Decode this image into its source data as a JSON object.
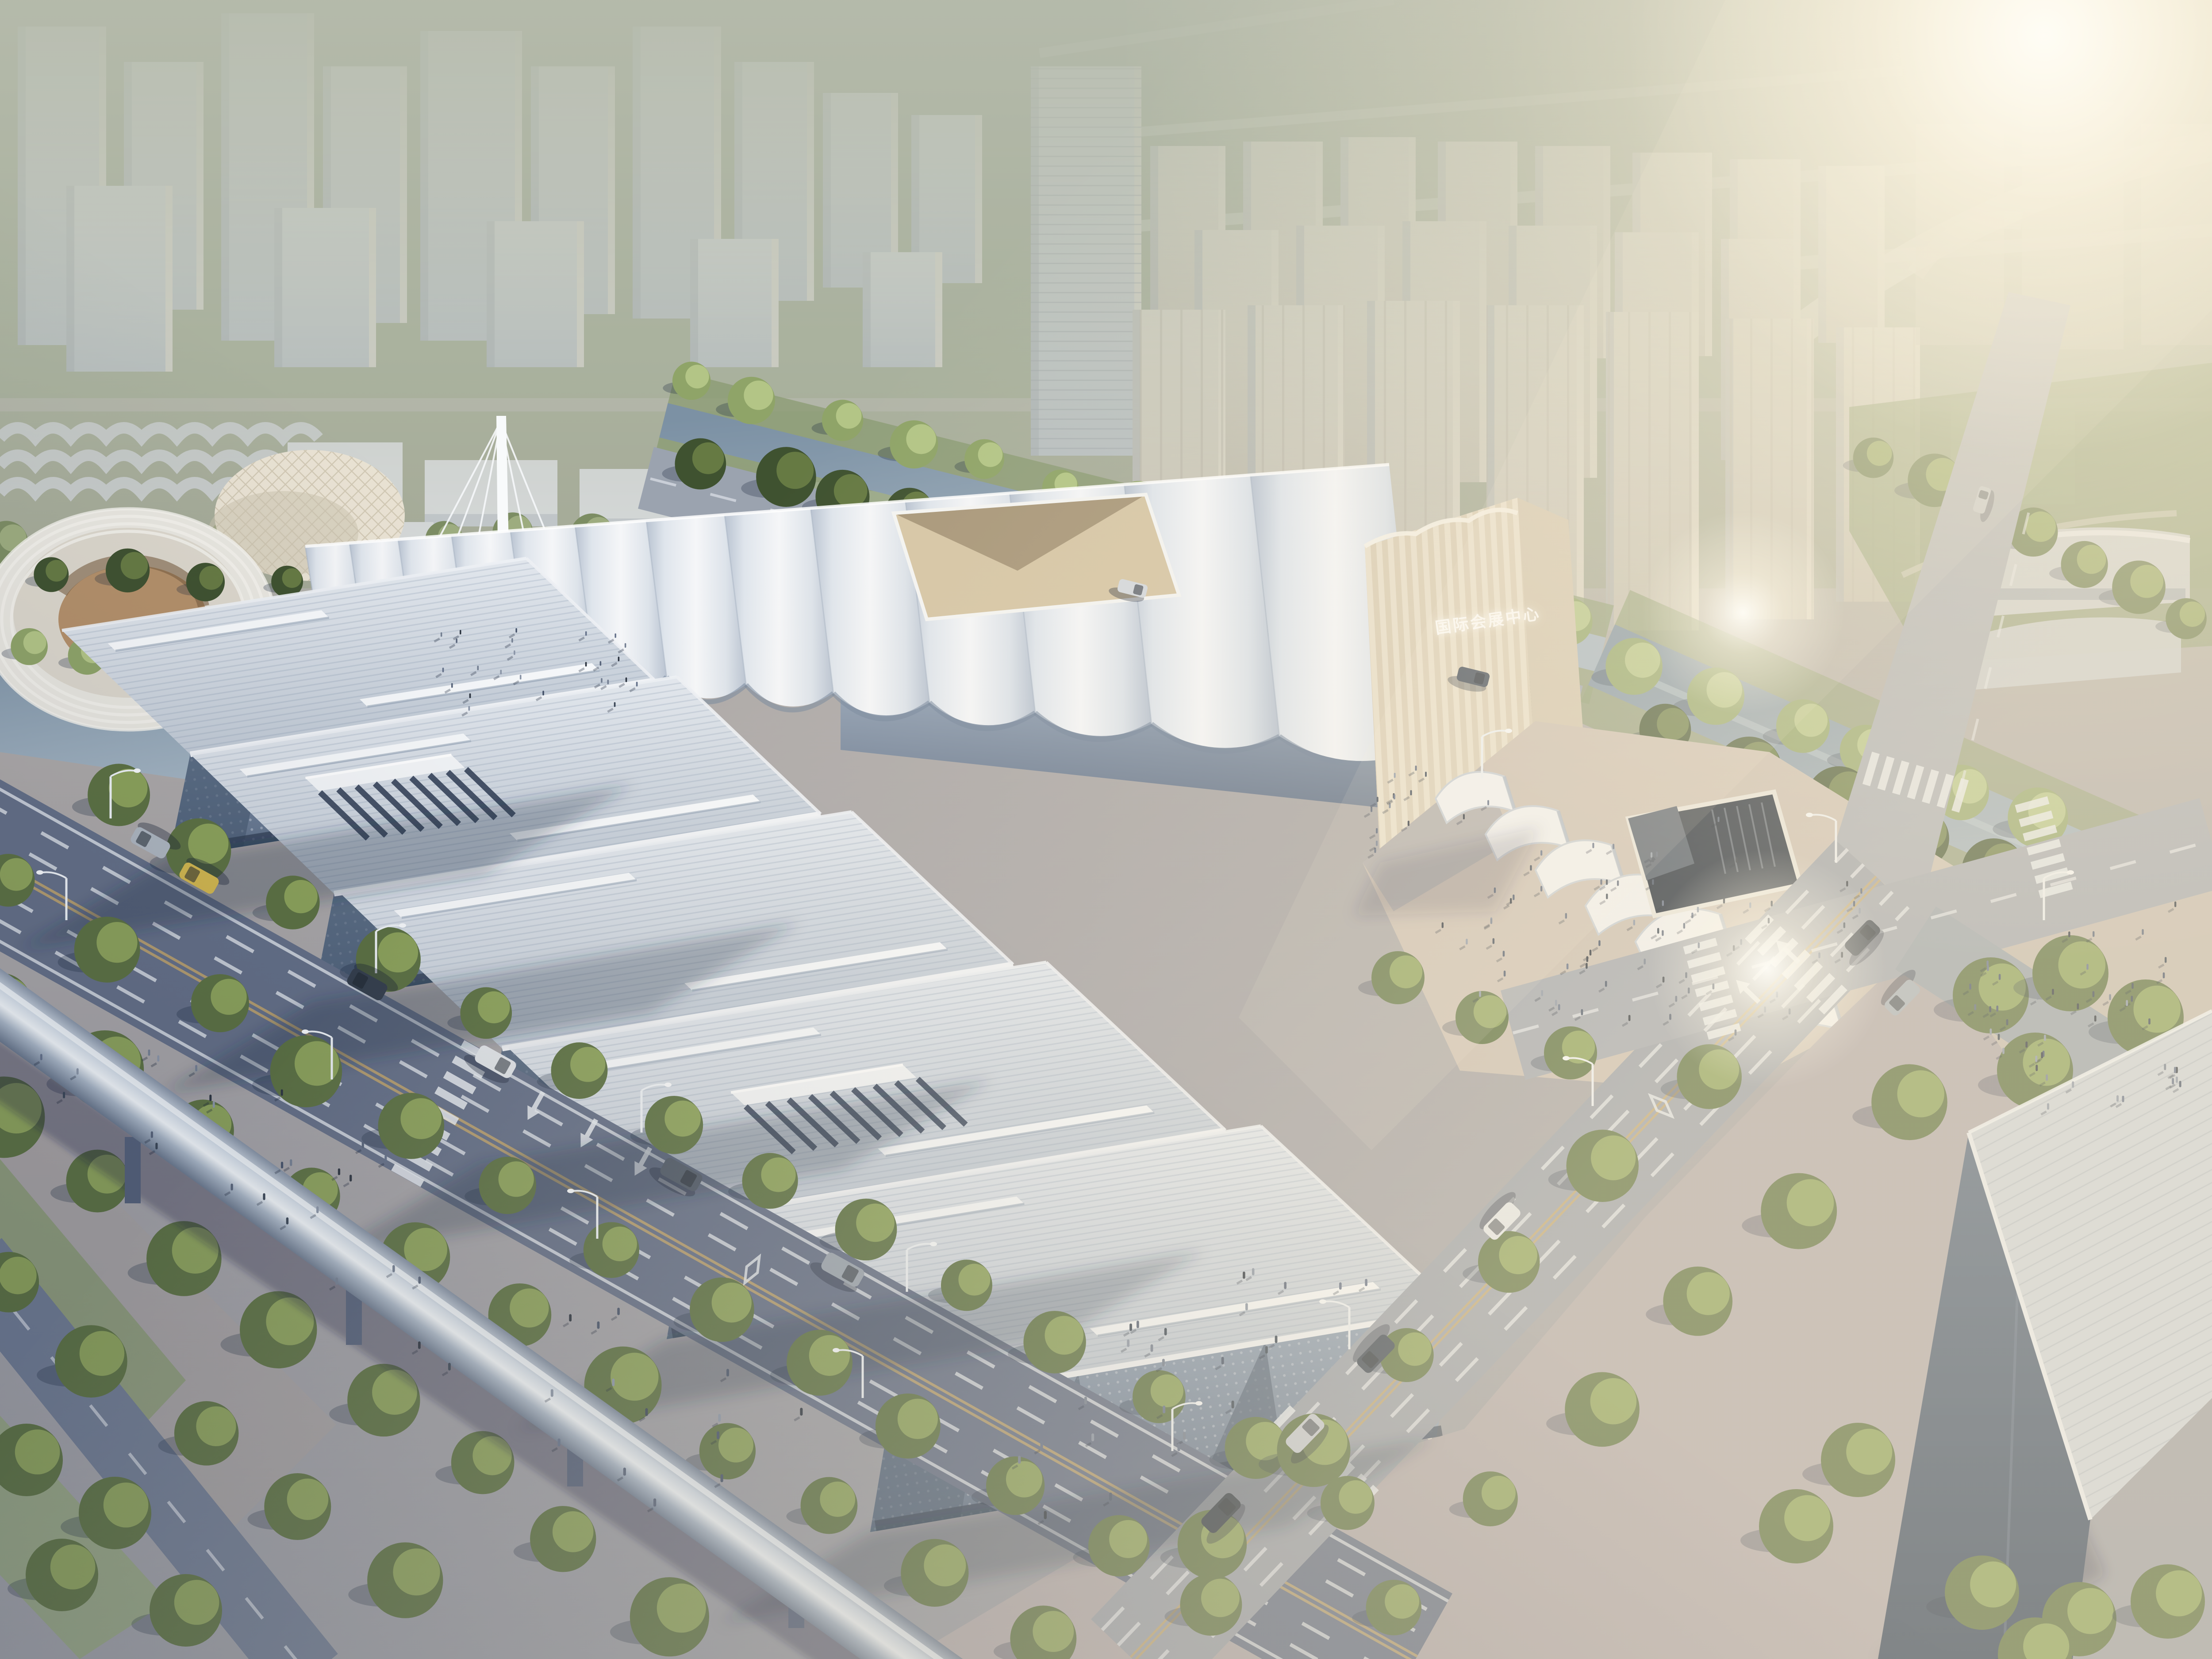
{
  "scene": {
    "type": "architectural-aerial-rendering",
    "subject": "exhibition-and-convention-center-complex",
    "building_sign": {
      "text": "国际会展中心"
    }
  },
  "palette": {
    "sky_top": "#a4ab9b",
    "sky_mid": "#b6baab",
    "sky_low": "#d8d8cb",
    "sun_core": "#fdf8ea",
    "warm_wash": "#f3e7c9",
    "field": "#95a285",
    "grass": "#8a9b72",
    "grass_bright": "#9fb083",
    "city_light": "#d4d8db",
    "city_shade": "#b6bec7",
    "city_warm": "#d8d3c6",
    "tree_dark": "#3f5230",
    "tree_mid": "#5c7142",
    "tree_light": "#94aa5e",
    "willow": "#8fa468",
    "willow_light": "#bacb8c",
    "tree_haze": "#7c8d63",
    "water": "#7b90a3",
    "water_light": "#a9bac7",
    "tent_white": "#f3f5f6",
    "tent_shade": "#c6cedb",
    "sign_wall": "#e9e0cd",
    "sign_wall_shade": "#d2c6ae",
    "sign_text_color": "#ffffff",
    "roof_light": "#e8ecf1",
    "roof_shade": "#c4cdd8",
    "fascia": "#f4f6f9",
    "facade": "#8496ad",
    "facade_dark": "#51627b",
    "facade_deep": "#3c4c62",
    "endwall": "#dcd8cf",
    "road_shade": "#646f87",
    "road_mid": "#7e8799",
    "road_light": "#9aa0ab",
    "road_warm": "#a9a5a8",
    "lane_white": "#e8ecf2",
    "lane_yellow": "#c7a86a",
    "pave_warm": "#ccc0b4",
    "pave_tan": "#b2997f",
    "pave_shade": "#7b869d",
    "plaza_mauve": "#b2aaad",
    "beam_dark": "#69788f",
    "beam_light": "#eef3f8",
    "lamp": "#eef2f6",
    "people": [
      "#2c3440",
      "#46536a",
      "#64718a",
      "#8b96a8",
      "#3a4656",
      "#58647a",
      "#747f92"
    ]
  }
}
